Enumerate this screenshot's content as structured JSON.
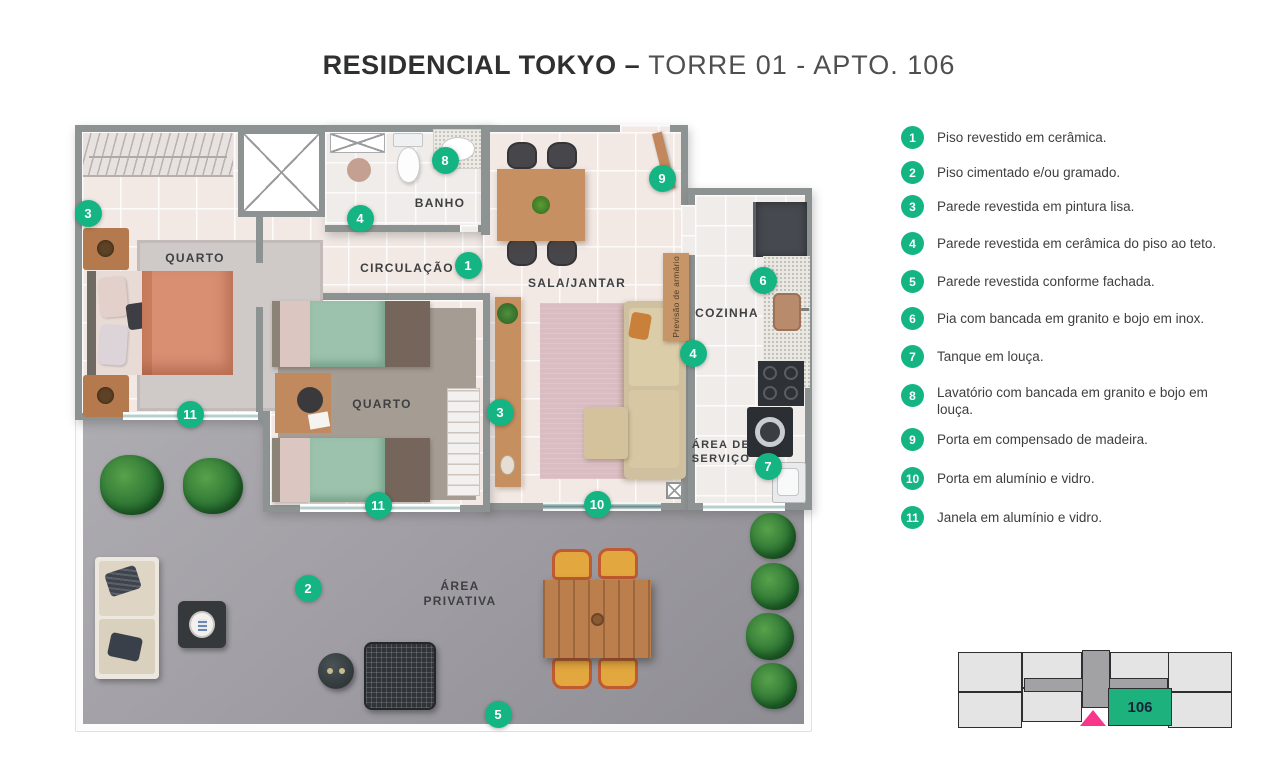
{
  "title": {
    "bold": "RESIDENCIAL TOKYO –",
    "light": "TORRE 01 - APTO. 106"
  },
  "colors": {
    "marker_green": "#14b583",
    "unit_green": "#1db17e",
    "arrow_pink": "#f7368c",
    "wall_gray": "#8d9293"
  },
  "legend": {
    "items": [
      {
        "num": "1",
        "text": "Piso revestido em cerâmica."
      },
      {
        "num": "2",
        "text": "Piso cimentado e/ou gramado."
      },
      {
        "num": "3",
        "text": "Parede revestida em pintura lisa."
      },
      {
        "num": "4",
        "text": "Parede revestida em cerâmica do piso ao teto."
      },
      {
        "num": "5",
        "text": "Parede revestida conforme fachada."
      },
      {
        "num": "6",
        "text": "Pia com bancada em granito e bojo em inox."
      },
      {
        "num": "7",
        "text": "Tanque em louça."
      },
      {
        "num": "8",
        "text": "Lavatório com bancada em granito e bojo em louça."
      },
      {
        "num": "9",
        "text": "Porta em compensado de madeira."
      },
      {
        "num": "10",
        "text": "Porta em alumínio e vidro."
      },
      {
        "num": "11",
        "text": "Janela em alumínio e vidro."
      }
    ]
  },
  "plan": {
    "rooms": {
      "quarto1": "QUARTO",
      "banho": "BANHO",
      "circulacao": "CIRCULAÇÃO",
      "sala": "SALA/JANTAR",
      "cozinha": "COZINHA",
      "quarto2": "QUARTO",
      "servico_l1": "ÁREA DE",
      "servico_l2": "SERVIÇO",
      "privativa_l1": "ÁREA",
      "privativa_l2": "PRIVATIVA",
      "armario": "Previsão de armário"
    },
    "markers": [
      {
        "n": "3",
        "x": 13,
        "y": 88
      },
      {
        "n": "8",
        "x": 370,
        "y": 35
      },
      {
        "n": "4",
        "x": 285,
        "y": 93
      },
      {
        "n": "1",
        "x": 393,
        "y": 140
      },
      {
        "n": "9",
        "x": 587,
        "y": 53
      },
      {
        "n": "6",
        "x": 688,
        "y": 155
      },
      {
        "n": "4",
        "x": 618,
        "y": 228
      },
      {
        "n": "3",
        "x": 425,
        "y": 287
      },
      {
        "n": "11",
        "x": 115,
        "y": 289
      },
      {
        "n": "11",
        "x": 303,
        "y": 380
      },
      {
        "n": "7",
        "x": 693,
        "y": 341
      },
      {
        "n": "10",
        "x": 522,
        "y": 379
      },
      {
        "n": "2",
        "x": 233,
        "y": 463
      },
      {
        "n": "5",
        "x": 423,
        "y": 589
      }
    ]
  },
  "keyplan": {
    "unit_label": "106"
  }
}
